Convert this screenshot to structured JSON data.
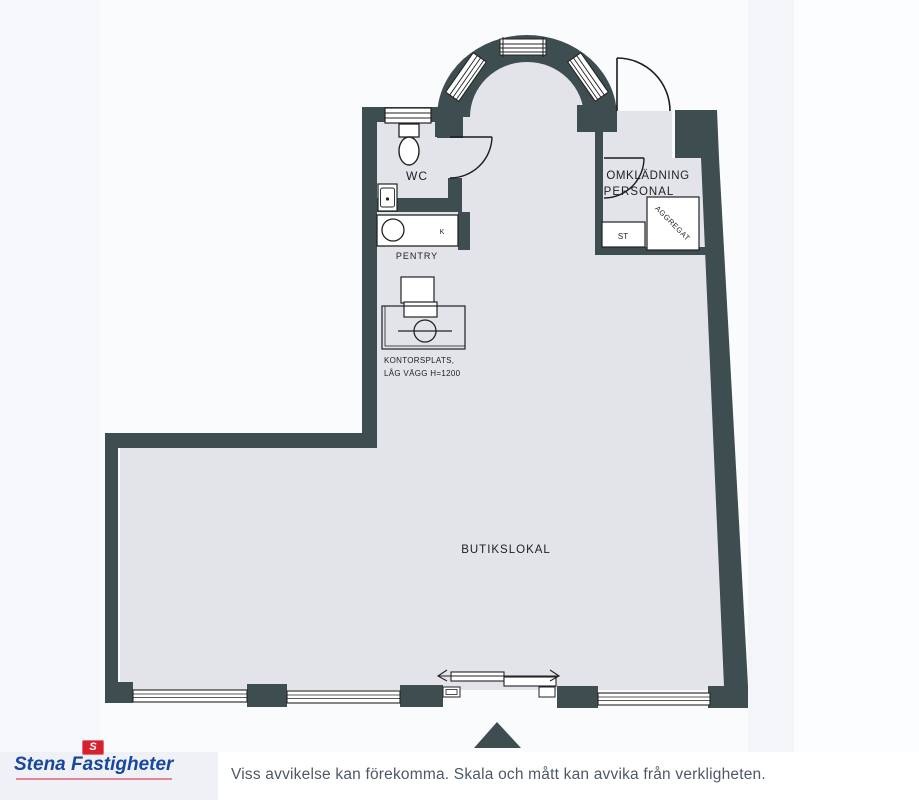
{
  "plan": {
    "labels": {
      "wc": "WC",
      "pentry": "PENTRY",
      "pentry_k": "K",
      "omkladning_line1": "OMKLÄDNING",
      "omkladning_line2": "PERSONAL",
      "st": "ST",
      "aggregat": "AGGREGAT",
      "kontor_line1": "KONTORSPLATS,",
      "kontor_line2": "LÅG VÄGG H=1200",
      "butik": "BUTIKSLOKAL"
    },
    "colors": {
      "wall": "#3e4d50",
      "floor": "#e3e4ea",
      "line": "#222222"
    }
  },
  "footer": {
    "logo_text": "Stena Fastigheter",
    "flag_letter": "S",
    "logo_color": "#17479e",
    "flag_color": "#d6212e",
    "disclaimer": "Viss avvikelse kan förekomma. Skala och mått kan avvika från verkligheten."
  }
}
